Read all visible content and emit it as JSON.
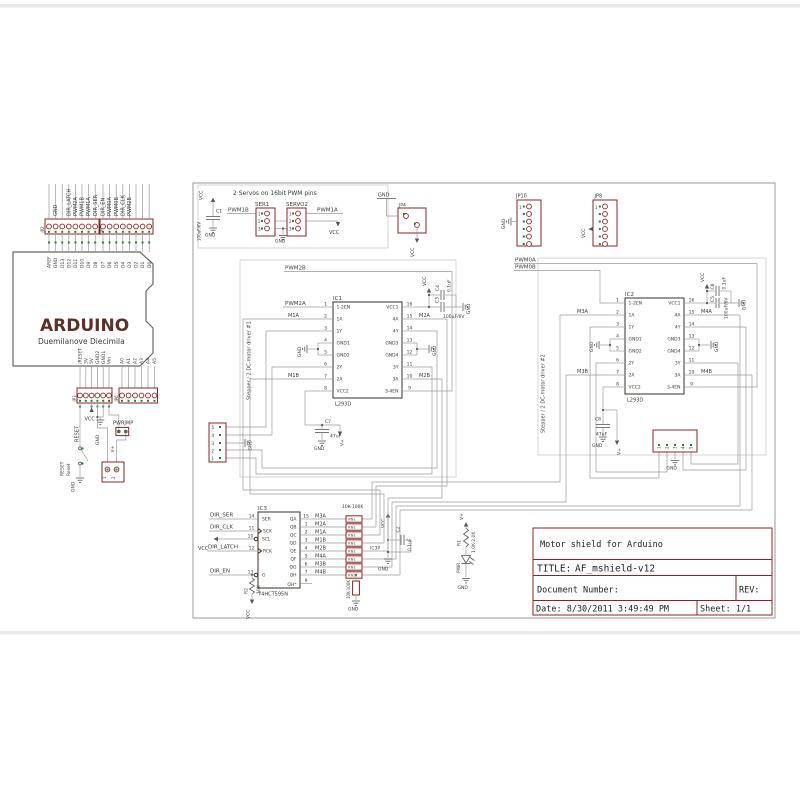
{
  "titleblock": {
    "project": "Motor shield for Arduino",
    "title_label": "TITLE:",
    "title": "AF_mshield-v12",
    "doc_label": "Document Number:",
    "rev_label": "REV:",
    "date": "Date: 8/30/2011 3:49:49 PM",
    "sheet": "Sheet: 1/1"
  },
  "arduino": {
    "name": "ARDUINO",
    "subtitle": "Duemilanove  Diecimila",
    "top_pins": [
      "AREF",
      "GND",
      "D13",
      "D12",
      "D11",
      "D10",
      "D9",
      "D8",
      "D7",
      "D6",
      "D5",
      "D4",
      "D3",
      "D2",
      "D1",
      "D0"
    ],
    "top_nets": [
      "GND",
      "DIR_LATCH",
      "PWM2A",
      "PWM1B",
      "PWM1A",
      "DIR_SER",
      "DIR_EN",
      "PWM0A",
      "PWM0B",
      "DIR_CLK",
      "PWM2B"
    ],
    "header_left": "JP2",
    "header_right": "JP1",
    "bottom_pins_left": [
      "/RESET",
      "3V",
      "5V",
      "GND2",
      "GND1",
      "Vin"
    ],
    "bottom_pins_right": [
      "A0",
      "A1",
      "A2",
      "A3",
      "A4",
      "A5"
    ],
    "bheader_left": "JP3",
    "bheader_right": "JP6",
    "reset_net": "RESET",
    "vcc": "VCC",
    "gnd": "GND",
    "gnd_sw": "GND",
    "pwrjmp": "PWRJMP",
    "vplus": "V+",
    "sw_label1": "RESET",
    "sw_label2": "Reset",
    "term_pin1": "1",
    "term_pin2": "2"
  },
  "servo": {
    "caption": "2 Servos on 16bit PWM pins",
    "vcc": "VCC",
    "vcc2": "VCC",
    "gnd": "GND",
    "gnd2": "GND",
    "c1_ref": "C1",
    "c1_val": "100uF/6V",
    "ser1": "SER1",
    "servo2": "SERVO2",
    "pins": [
      "1",
      "2",
      "3"
    ],
    "pwm1b": "PWM1B",
    "pwm1a": "PWM1A"
  },
  "jp4": {
    "ref": "JP4",
    "gnd": "GND",
    "vcc": "VCC"
  },
  "jp10": {
    "ref": "JP10",
    "gnd": "GND",
    "pin1": "1"
  },
  "jp8": {
    "ref": "JP8",
    "vcc": "VCC",
    "pin1": "1"
  },
  "driver1": {
    "caption": "Stepper / 2 DC-motor driver #1",
    "ref": "IC1",
    "part": "L293D",
    "left": [
      {
        "n": "1",
        "name": "1-2EN"
      },
      {
        "n": "2",
        "name": "1A"
      },
      {
        "n": "3",
        "name": "1Y"
      },
      {
        "n": "4",
        "name": "GND1"
      },
      {
        "n": "5",
        "name": "GND2"
      },
      {
        "n": "6",
        "name": "2Y"
      },
      {
        "n": "7",
        "name": "2A"
      },
      {
        "n": "8",
        "name": "VCC2"
      }
    ],
    "right": [
      {
        "n": "16",
        "name": "VCC1"
      },
      {
        "n": "15",
        "name": "4A"
      },
      {
        "n": "14",
        "name": "4Y"
      },
      {
        "n": "13",
        "name": "GND3"
      },
      {
        "n": "12",
        "name": "GND4"
      },
      {
        "n": "11",
        "name": "3Y"
      },
      {
        "n": "10",
        "name": "3A"
      },
      {
        "n": "9",
        "name": "3-4EN"
      }
    ],
    "pwm2b": "PWM2B",
    "pwm2a": "PWM2A",
    "m1a": "M1A",
    "m1b": "M1B",
    "m2a": "M2A",
    "m2b": "M2B",
    "vcc": "VCC",
    "gnd_l": "GND",
    "gnd_r": "GND",
    "gnd_c": "GND",
    "gnd_m": "GND",
    "gnd_c7": "GND",
    "c4_ref": "C4",
    "c4_val": "0.1uF",
    "c3_ref": "C3",
    "c3_val": "100uF/6V",
    "c7_ref": "C7",
    "c7_val": "47uF",
    "vplus": "V+",
    "conn_pins": [
      "5",
      "4",
      "3",
      "2",
      "1"
    ]
  },
  "driver2": {
    "caption": "Stepper / 2 DC-motor driver #2",
    "ref": "IC2",
    "part": "L293D",
    "left": [
      {
        "n": "1",
        "name": "1-2EN"
      },
      {
        "n": "2",
        "name": "1A"
      },
      {
        "n": "3",
        "name": "1Y"
      },
      {
        "n": "4",
        "name": "GND1"
      },
      {
        "n": "5",
        "name": "GND2"
      },
      {
        "n": "6",
        "name": "2Y"
      },
      {
        "n": "7",
        "name": "2A"
      },
      {
        "n": "8",
        "name": "VCC2"
      }
    ],
    "right": [
      {
        "n": "16",
        "name": "VCC1"
      },
      {
        "n": "15",
        "name": "4A"
      },
      {
        "n": "14",
        "name": "4Y"
      },
      {
        "n": "13",
        "name": "GND3"
      },
      {
        "n": "12",
        "name": "GND4"
      },
      {
        "n": "11",
        "name": "3Y"
      },
      {
        "n": "10",
        "name": "3A"
      },
      {
        "n": "9",
        "name": "3-4EN"
      }
    ],
    "pwm0a": "PWM0A",
    "pwm0b": "PWM0B",
    "m3a": "M3A",
    "m3b": "M3B",
    "m4a": "M4A",
    "m4b": "M4B",
    "vcc": "VCC",
    "gnd_l": "GND",
    "gnd_r": "GND",
    "gnd_c": "GND",
    "gnd_m": "GND",
    "gnd_c8": "GND",
    "c6_ref": "C6",
    "c6_val": "0.1uF",
    "c5_ref": "C5",
    "c5_val": "100uF/6V",
    "c8_ref": "C8",
    "c8_val": "47uF",
    "vplus": "V+",
    "conn_pins": [
      "1",
      "2",
      "3",
      "4",
      "5"
    ]
  },
  "shift": {
    "ref": "IC3",
    "part": "74HCT595N",
    "left": [
      {
        "n": "14",
        "name": "SER"
      },
      {
        "n": "11",
        "name": "SCK"
      },
      {
        "n": "10",
        "name": "SCL"
      },
      {
        "n": "12",
        "name": "RCK"
      },
      {
        "n": "13",
        "name": "G"
      }
    ],
    "right": [
      {
        "n": "15",
        "name": "QA",
        "net": "M3A"
      },
      {
        "n": "1",
        "name": "QB",
        "net": "M2A"
      },
      {
        "n": "2",
        "name": "QC",
        "net": "M1A"
      },
      {
        "n": "3",
        "name": "QD",
        "net": "M1B"
      },
      {
        "n": "4",
        "name": "QE",
        "net": "M2B"
      },
      {
        "n": "5",
        "name": "QF",
        "net": "M4A"
      },
      {
        "n": "6",
        "name": "QG",
        "net": "M3B"
      },
      {
        "n": "7",
        "name": "QH",
        "net": "M4B"
      }
    ],
    "qh2_n": "9",
    "qh2_name": "QH*",
    "dir_ser": "DIR_SER",
    "dir_clk": "DIR_CLK",
    "dir_latch": "DIR_LATCH",
    "dir_en": "DIR_EN",
    "vcc_scl": "VCC",
    "vcc_r2": "VCC",
    "rn_header": "10K-100K",
    "rn_ref": "RN1",
    "r2_ref": "R2",
    "r2_val": "10K",
    "rn9_val": "10K-100K",
    "rn9_gnd": "GND",
    "ic3p": "IC3P",
    "ic3p_vcc": "VCC",
    "c2_ref": "C2",
    "c2_val": "0.1uF",
    "ic3p_gnd": "GND",
    "r1_ref": "R1",
    "r1_val": "1.0K-2.0K",
    "vplus": "V+",
    "led": "PWR",
    "led_gnd": "GND"
  }
}
